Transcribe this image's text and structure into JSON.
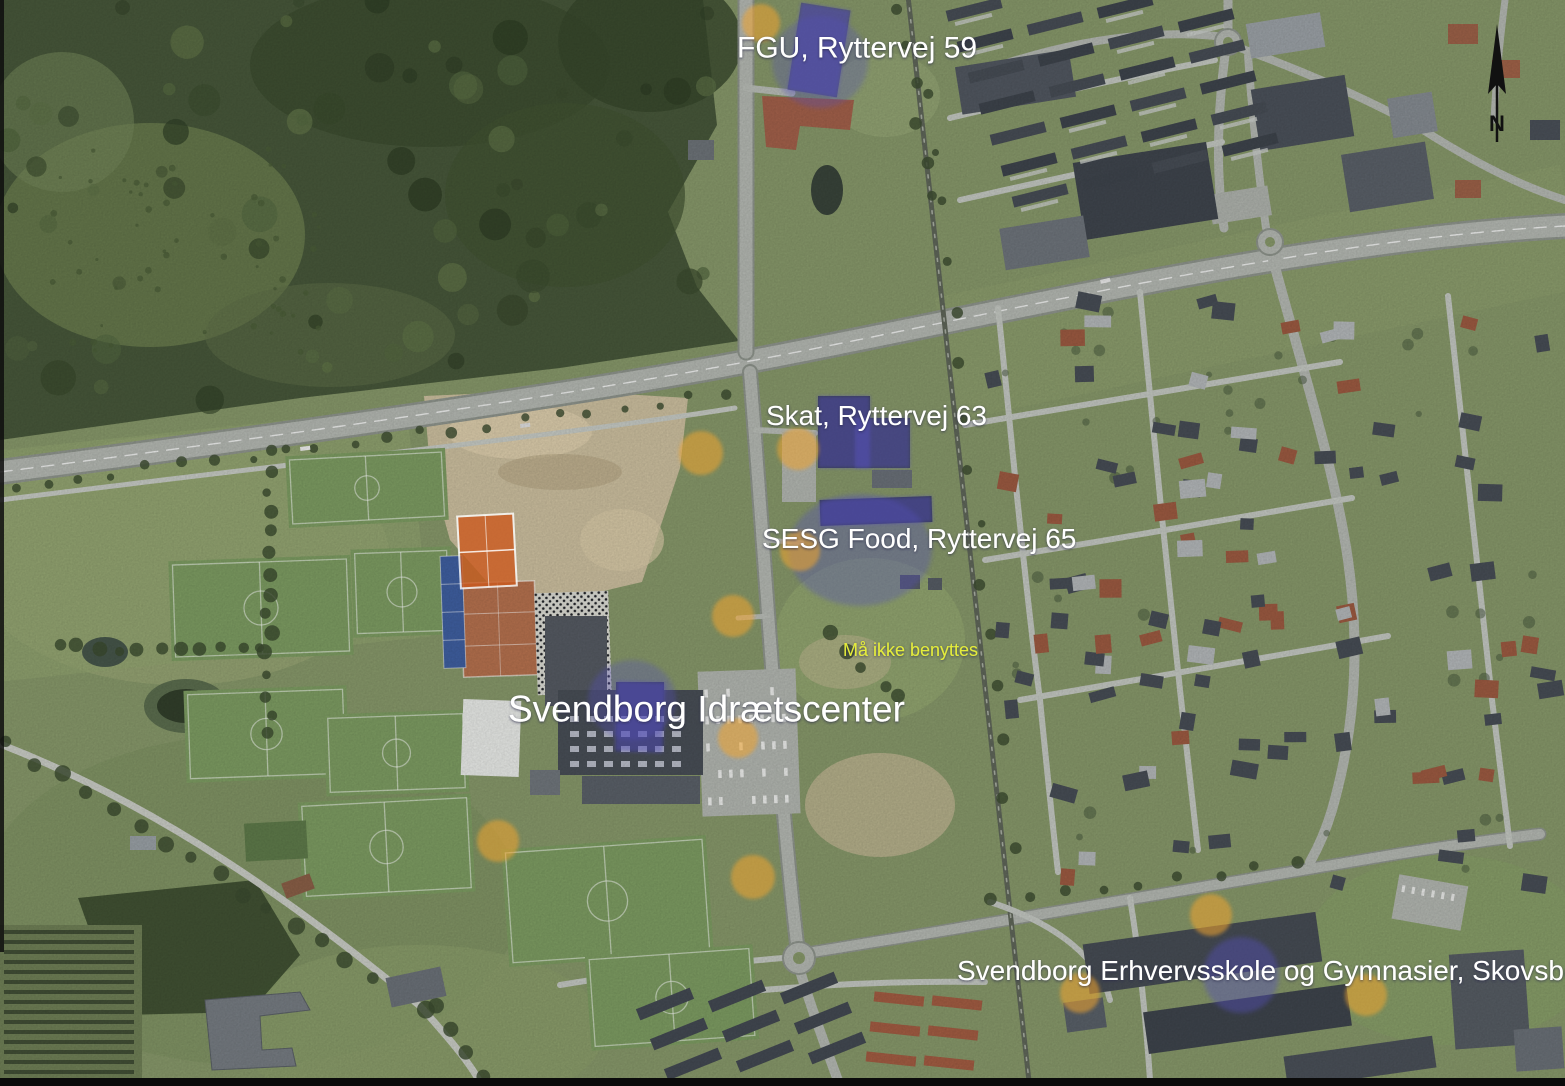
{
  "map": {
    "labels": [
      {
        "id": "fgu",
        "text": "FGU, Ryttervej 59",
        "x": 737,
        "y": 33,
        "font_size": 30,
        "color": "#ffffff"
      },
      {
        "id": "skat",
        "text": "Skat, Ryttervej 63",
        "x": 766,
        "y": 402,
        "font_size": 28,
        "color": "#ffffff"
      },
      {
        "id": "sesg-food",
        "text": "SESG Food, Ryttervej 65",
        "x": 762,
        "y": 525,
        "font_size": 28,
        "color": "#ffffff"
      },
      {
        "id": "maa-ikke-benyttes",
        "text": "Må ikke benyttes",
        "x": 843,
        "y": 641,
        "font_size": 18,
        "color": "#e4ec3a"
      },
      {
        "id": "idraetscenter",
        "text": "Svendborg Idrætscenter",
        "x": 508,
        "y": 691,
        "font_size": 37,
        "color": "#ffffff"
      },
      {
        "id": "erhvervsskole",
        "text": "Svendborg Erhvervsskole og Gymnasier, Skovsbovej 43",
        "x": 957,
        "y": 957,
        "font_size": 28,
        "color": "#ffffff"
      }
    ],
    "annotation_colors": {
      "highlight_circle": "#f2a52e",
      "building_overlay": "#5550bc",
      "court_highlight": "#cc5a1e",
      "warning_text": "#e4ec3a",
      "label_text": "#ffffff",
      "north_arrow": "#111111"
    },
    "highlight_circles": [
      {
        "x": 761,
        "y": 23,
        "r": 19
      },
      {
        "x": 701,
        "y": 453,
        "r": 22
      },
      {
        "x": 798,
        "y": 449,
        "r": 21
      },
      {
        "x": 800,
        "y": 551,
        "r": 20
      },
      {
        "x": 733,
        "y": 616,
        "r": 21
      },
      {
        "x": 738,
        "y": 738,
        "r": 20
      },
      {
        "x": 498,
        "y": 841,
        "r": 21
      },
      {
        "x": 753,
        "y": 877,
        "r": 22
      },
      {
        "x": 1080,
        "y": 993,
        "r": 20
      },
      {
        "x": 1211,
        "y": 915,
        "r": 21
      },
      {
        "x": 1366,
        "y": 995,
        "r": 21
      }
    ],
    "building_overlays": [
      {
        "part": "fgu-building",
        "shape": "rect",
        "x": 794,
        "y": 6,
        "w": 50,
        "h": 88,
        "rot": 9,
        "opacity": 0.5
      },
      {
        "part": "fgu-halo",
        "shape": "ellipse",
        "cx": 820,
        "cy": 62,
        "rx": 48,
        "ry": 46,
        "opacity": 0.3
      },
      {
        "part": "skat-building-a",
        "shape": "rect",
        "x": 818,
        "y": 396,
        "w": 52,
        "h": 72,
        "rot": 0,
        "opacity": 0.5
      },
      {
        "part": "skat-building-b",
        "shape": "rect",
        "x": 855,
        "y": 418,
        "w": 55,
        "h": 50,
        "rot": 0,
        "opacity": 0.45
      },
      {
        "part": "sesg-building",
        "shape": "rect",
        "x": 820,
        "y": 498,
        "w": 112,
        "h": 26,
        "rot": -2,
        "opacity": 0.5
      },
      {
        "part": "sesg-halo",
        "shape": "ellipse",
        "cx": 860,
        "cy": 550,
        "rx": 72,
        "ry": 56,
        "opacity": 0.35
      },
      {
        "part": "idraetscenter-building",
        "shape": "rect",
        "x": 616,
        "y": 682,
        "w": 48,
        "h": 70,
        "rot": 2,
        "opacity": 0.5
      },
      {
        "part": "idraetscenter-halo",
        "shape": "ellipse",
        "cx": 632,
        "cy": 700,
        "rx": 44,
        "ry": 40,
        "opacity": 0.32
      },
      {
        "part": "erhvervsskole-halo",
        "shape": "ellipse",
        "cx": 1241,
        "cy": 975,
        "rx": 38,
        "ry": 38,
        "opacity": 0.42
      }
    ],
    "court_highlight": {
      "x": 459,
      "y": 515,
      "w": 56,
      "h": 72,
      "rot": -3
    },
    "north_arrow": {
      "x": 1497,
      "y": 24,
      "shaft_bottom": 142,
      "letter": "N"
    }
  }
}
